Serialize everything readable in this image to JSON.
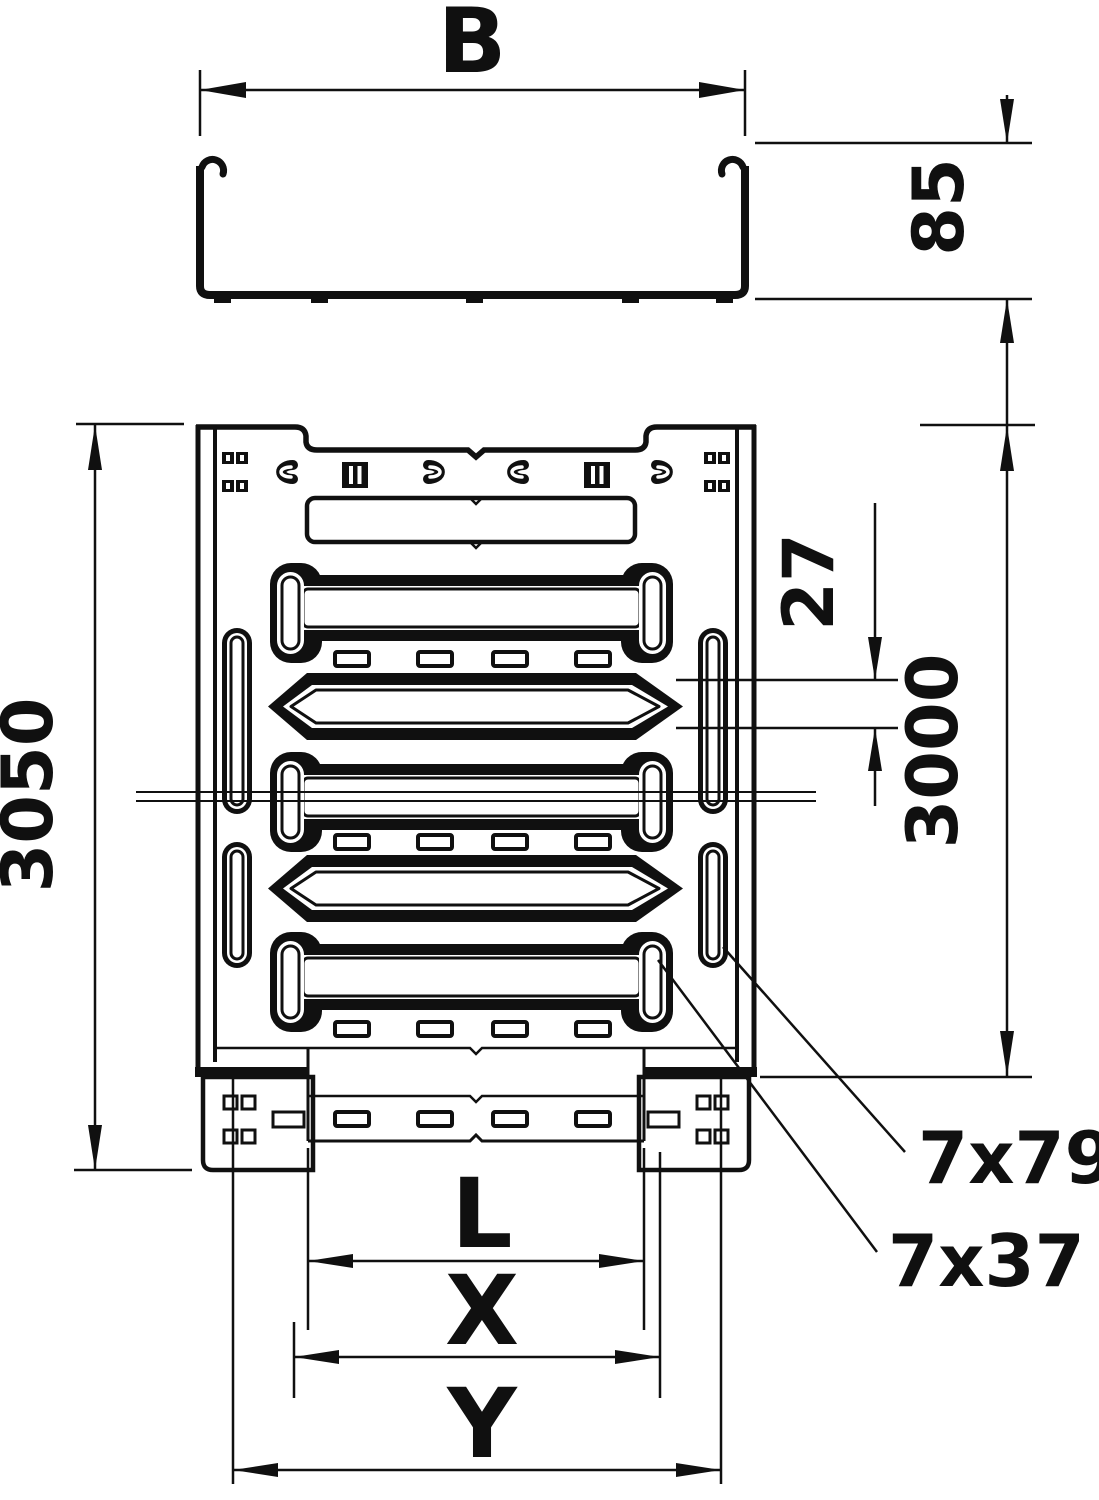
{
  "drawing": {
    "labels": {
      "width_top": "B",
      "side_height": "85",
      "total_length": "3050",
      "nominal_length": "3000",
      "slot_offset": "27",
      "rail_slot_size": "7x79",
      "floor_slot_size": "7x37",
      "dim_l": "L",
      "dim_x": "X",
      "dim_y": "Y"
    },
    "colors": {
      "line": "#101010",
      "background": "#ffffff"
    }
  }
}
